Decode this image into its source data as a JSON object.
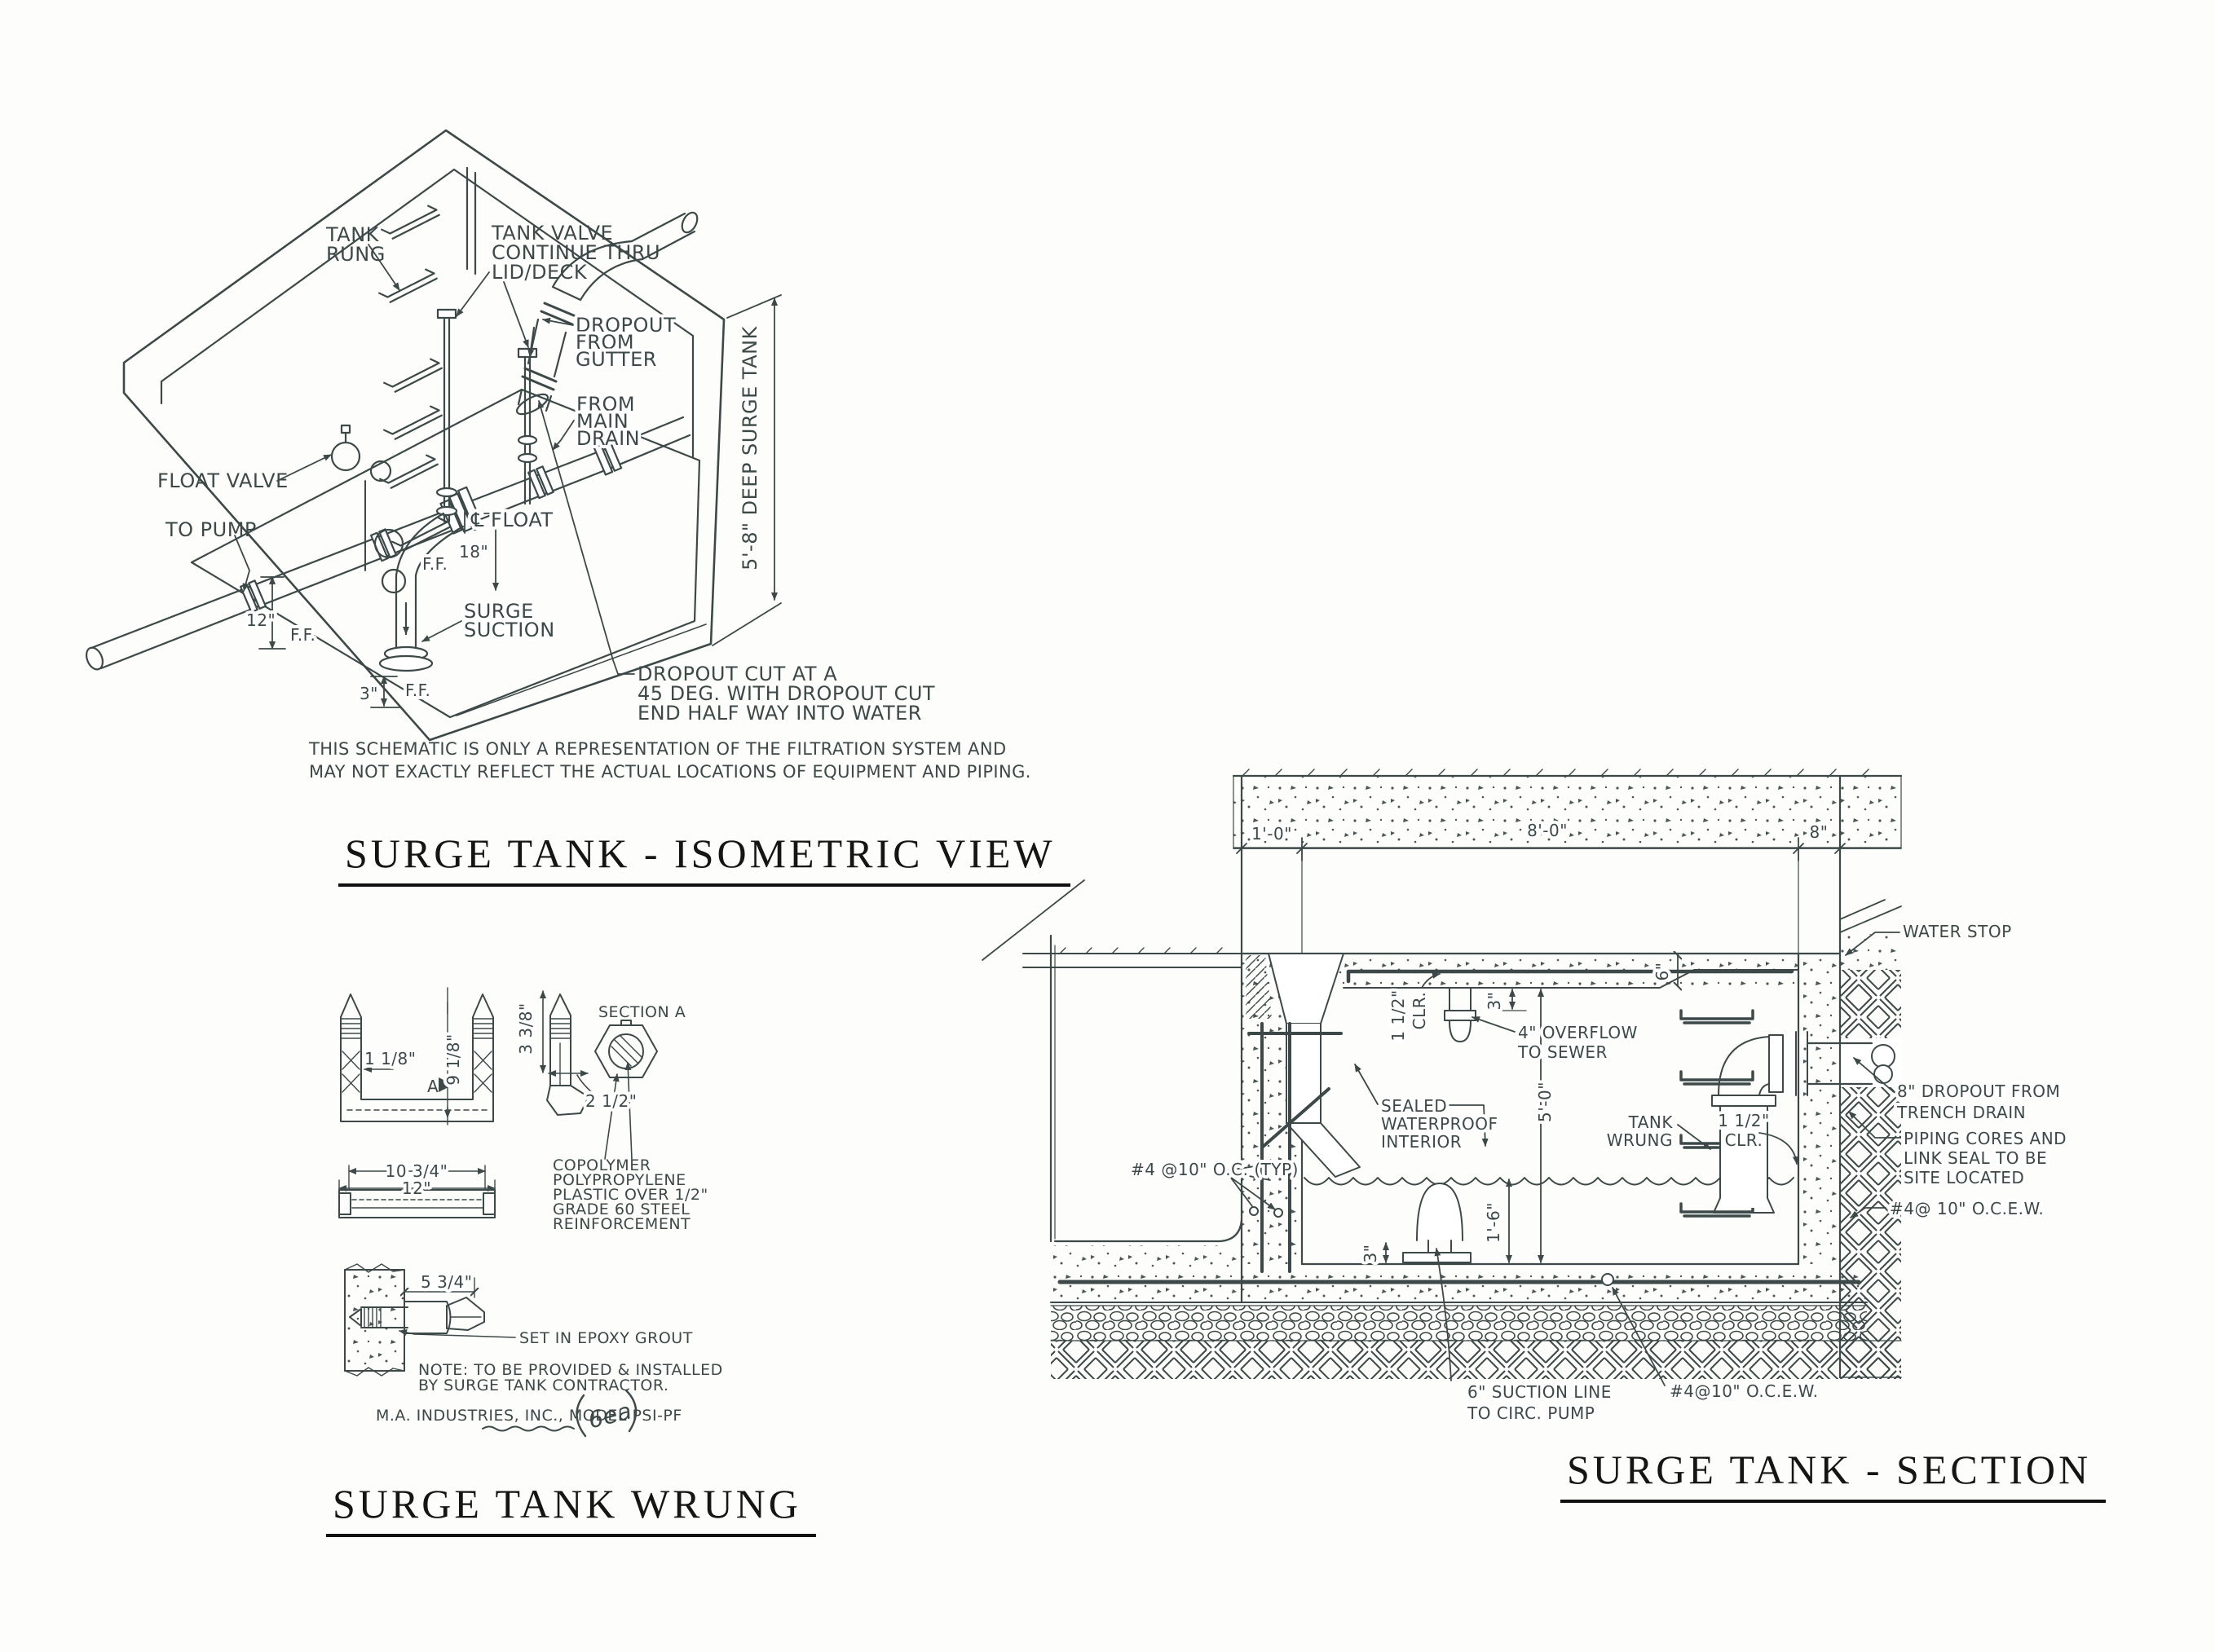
{
  "colors": {
    "ink": "#3c4948",
    "title": "#151515",
    "background": "#fdfdfb"
  },
  "iso": {
    "title": "SURGE TANK - ISOMETRIC VIEW",
    "note": [
      "THIS SCHEMATIC IS ONLY A REPRESENTATION OF THE FILTRATION SYSTEM AND",
      "MAY NOT EXACTLY REFLECT THE ACTUAL LOCATIONS OF EQUIPMENT AND PIPING."
    ],
    "labels": {
      "tank_rung": [
        "TANK",
        "RUNG"
      ],
      "tank_valve": [
        "TANK VALVE",
        "CONTINUE THRU",
        "LID/DECK"
      ],
      "dropout_gutter": [
        "DROPOUT",
        "FROM",
        "GUTTER"
      ],
      "from_main_drain": [
        "FROM",
        "MAIN",
        "DRAIN"
      ],
      "float_valve": "FLOAT VALVE",
      "to_pump": "TO PUMP",
      "cl_float": "℄ FLOAT",
      "dim_18": "18\"",
      "ff_18": "F.F.",
      "dim_12": "12\"",
      "ff_12": "F.F.",
      "surge_suction": [
        "SURGE",
        "SUCTION"
      ],
      "dim_3": "3\"",
      "ff_3": "F.F.",
      "deep_tank": "5'-8\" DEEP SURGE TANK",
      "dropout_cut": [
        "DROPOUT CUT AT A",
        "45 DEG. WITH DROPOUT CUT",
        "END HALF WAY INTO WATER"
      ]
    }
  },
  "wrung": {
    "title": "SURGE TANK WRUNG",
    "labels": {
      "dim_1_18": "1 1/8\"",
      "dim_9_18": "9 1/8\"",
      "a_marker": "A",
      "dim_3_38": "3 3/8\"",
      "section_a": "SECTION A",
      "dim_2_12": "2 1/2\"",
      "dim_10_34": "10 3/4\"",
      "dim_12": "12\"",
      "copolymer": [
        "COPOLYMER",
        "POLYPROPYLENE",
        "PLASTIC OVER 1/2\"",
        "GRADE 60 STEEL",
        "REINFORCEMENT"
      ],
      "dim_5_34": "5 3/4\"",
      "epoxy": "SET IN EPOXY GROUT",
      "note": [
        "NOTE: TO BE PROVIDED & INSTALLED",
        "BY SURGE TANK CONTRACTOR."
      ],
      "manufacturer": "M.A. INDUSTRIES, INC., MODEL PSI-PF",
      "handwritten": "6ea"
    }
  },
  "section": {
    "title": "SURGE TANK - SECTION",
    "labels": {
      "dim_1ft": "1'-0\"",
      "dim_8ft": "8'-0\"",
      "dim_8in": "8\"",
      "water_stop": "WATER STOP",
      "clr_top": [
        "1 1/2\"",
        "CLR."
      ],
      "dim_3in_top": "3\"",
      "overflow": [
        "4\" OVERFLOW",
        "TO SEWER"
      ],
      "dim_6in": "6\"",
      "sealed": [
        "SEALED",
        "WATERPROOF",
        "INTERIOR"
      ],
      "dim_5ft": "5'-0\"",
      "tank_wrung": [
        "TANK",
        "WRUNG"
      ],
      "clr_right": [
        "1 1/2\"",
        "CLR."
      ],
      "dropout_trench": [
        "8\" DROPOUT FROM",
        "TRENCH DRAIN"
      ],
      "piping_cores": [
        "PIPING CORES AND",
        "LINK SEAL TO BE",
        "SITE LOCATED"
      ],
      "rebar_right": "#4@ 10\" O.C.E.W.",
      "rebar_typ": "#4 @10\" O.C. (TYP)",
      "dim_1ft6": "1'-6\"",
      "dim_3in_floor": "3\"",
      "suction_line": [
        "6\" SUCTION LINE",
        "TO CIRC. PUMP"
      ],
      "rebar_bottom": "#4@10\" O.C.E.W."
    }
  }
}
